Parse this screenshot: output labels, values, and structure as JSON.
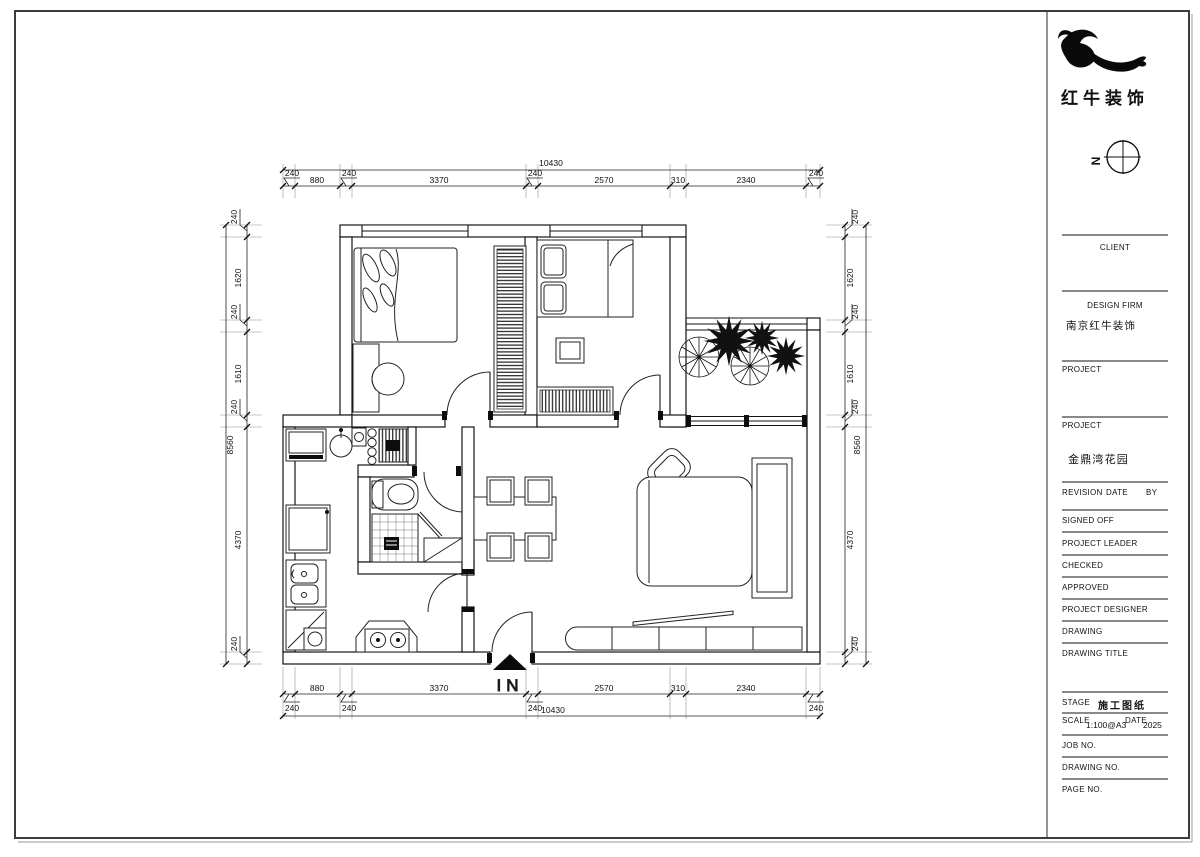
{
  "brand": {
    "name": "红牛装饰"
  },
  "north": {
    "label": "N"
  },
  "titleblock": {
    "client_label": "CLIENT",
    "design_firm_label": "DESIGN  FIRM",
    "design_firm_value": "南京红牛装饰",
    "project_label": "PROJECT",
    "project2_label": "PROJECT",
    "project_value": "金鼎湾花园",
    "revision_label": "REVISION",
    "date_label": "DATE",
    "by_label": "BY",
    "signed_off_label": "SIGNED  OFF",
    "project_leader_label": "PROJECT  LEADER",
    "checked_label": "CHECKED",
    "approved_label": "APPROVED",
    "project_designer_label": "PROJECT  DESIGNER",
    "drawing_label": "DRAWING",
    "drawing_title_label": "DRAWING  TITLE",
    "stage_label": "STAGE",
    "stage_value": "施工图纸",
    "scale_label": "SCALE",
    "scale_value": "1:100@A3",
    "date2_label": "DATE",
    "date_value": "2025",
    "job_no_label": "JOB  NO.",
    "drawing_no_label": "DRAWING  NO.",
    "page_no_label": "PAGE  NO."
  },
  "plan": {
    "entrance_label": "IN",
    "dims": {
      "top": {
        "total": "10430",
        "segs": [
          "880",
          "3370",
          "2570",
          "310",
          "2340"
        ],
        "offsets": [
          "240",
          "240",
          "240",
          "240"
        ]
      },
      "bottom": {
        "total": "10430",
        "segs": [
          "880",
          "3370",
          "2570",
          "310",
          "2340"
        ],
        "offsets": [
          "240",
          "240",
          "240",
          "240"
        ]
      },
      "left": {
        "total": "8560",
        "segs": [
          "1620",
          "1610",
          "4370"
        ],
        "offsets": [
          "240",
          "240",
          "240",
          "240"
        ]
      },
      "right": {
        "total": "8560",
        "segs": [
          "1620",
          "1610",
          "4370"
        ],
        "offsets": [
          "240",
          "240",
          "240",
          "240"
        ]
      }
    }
  }
}
